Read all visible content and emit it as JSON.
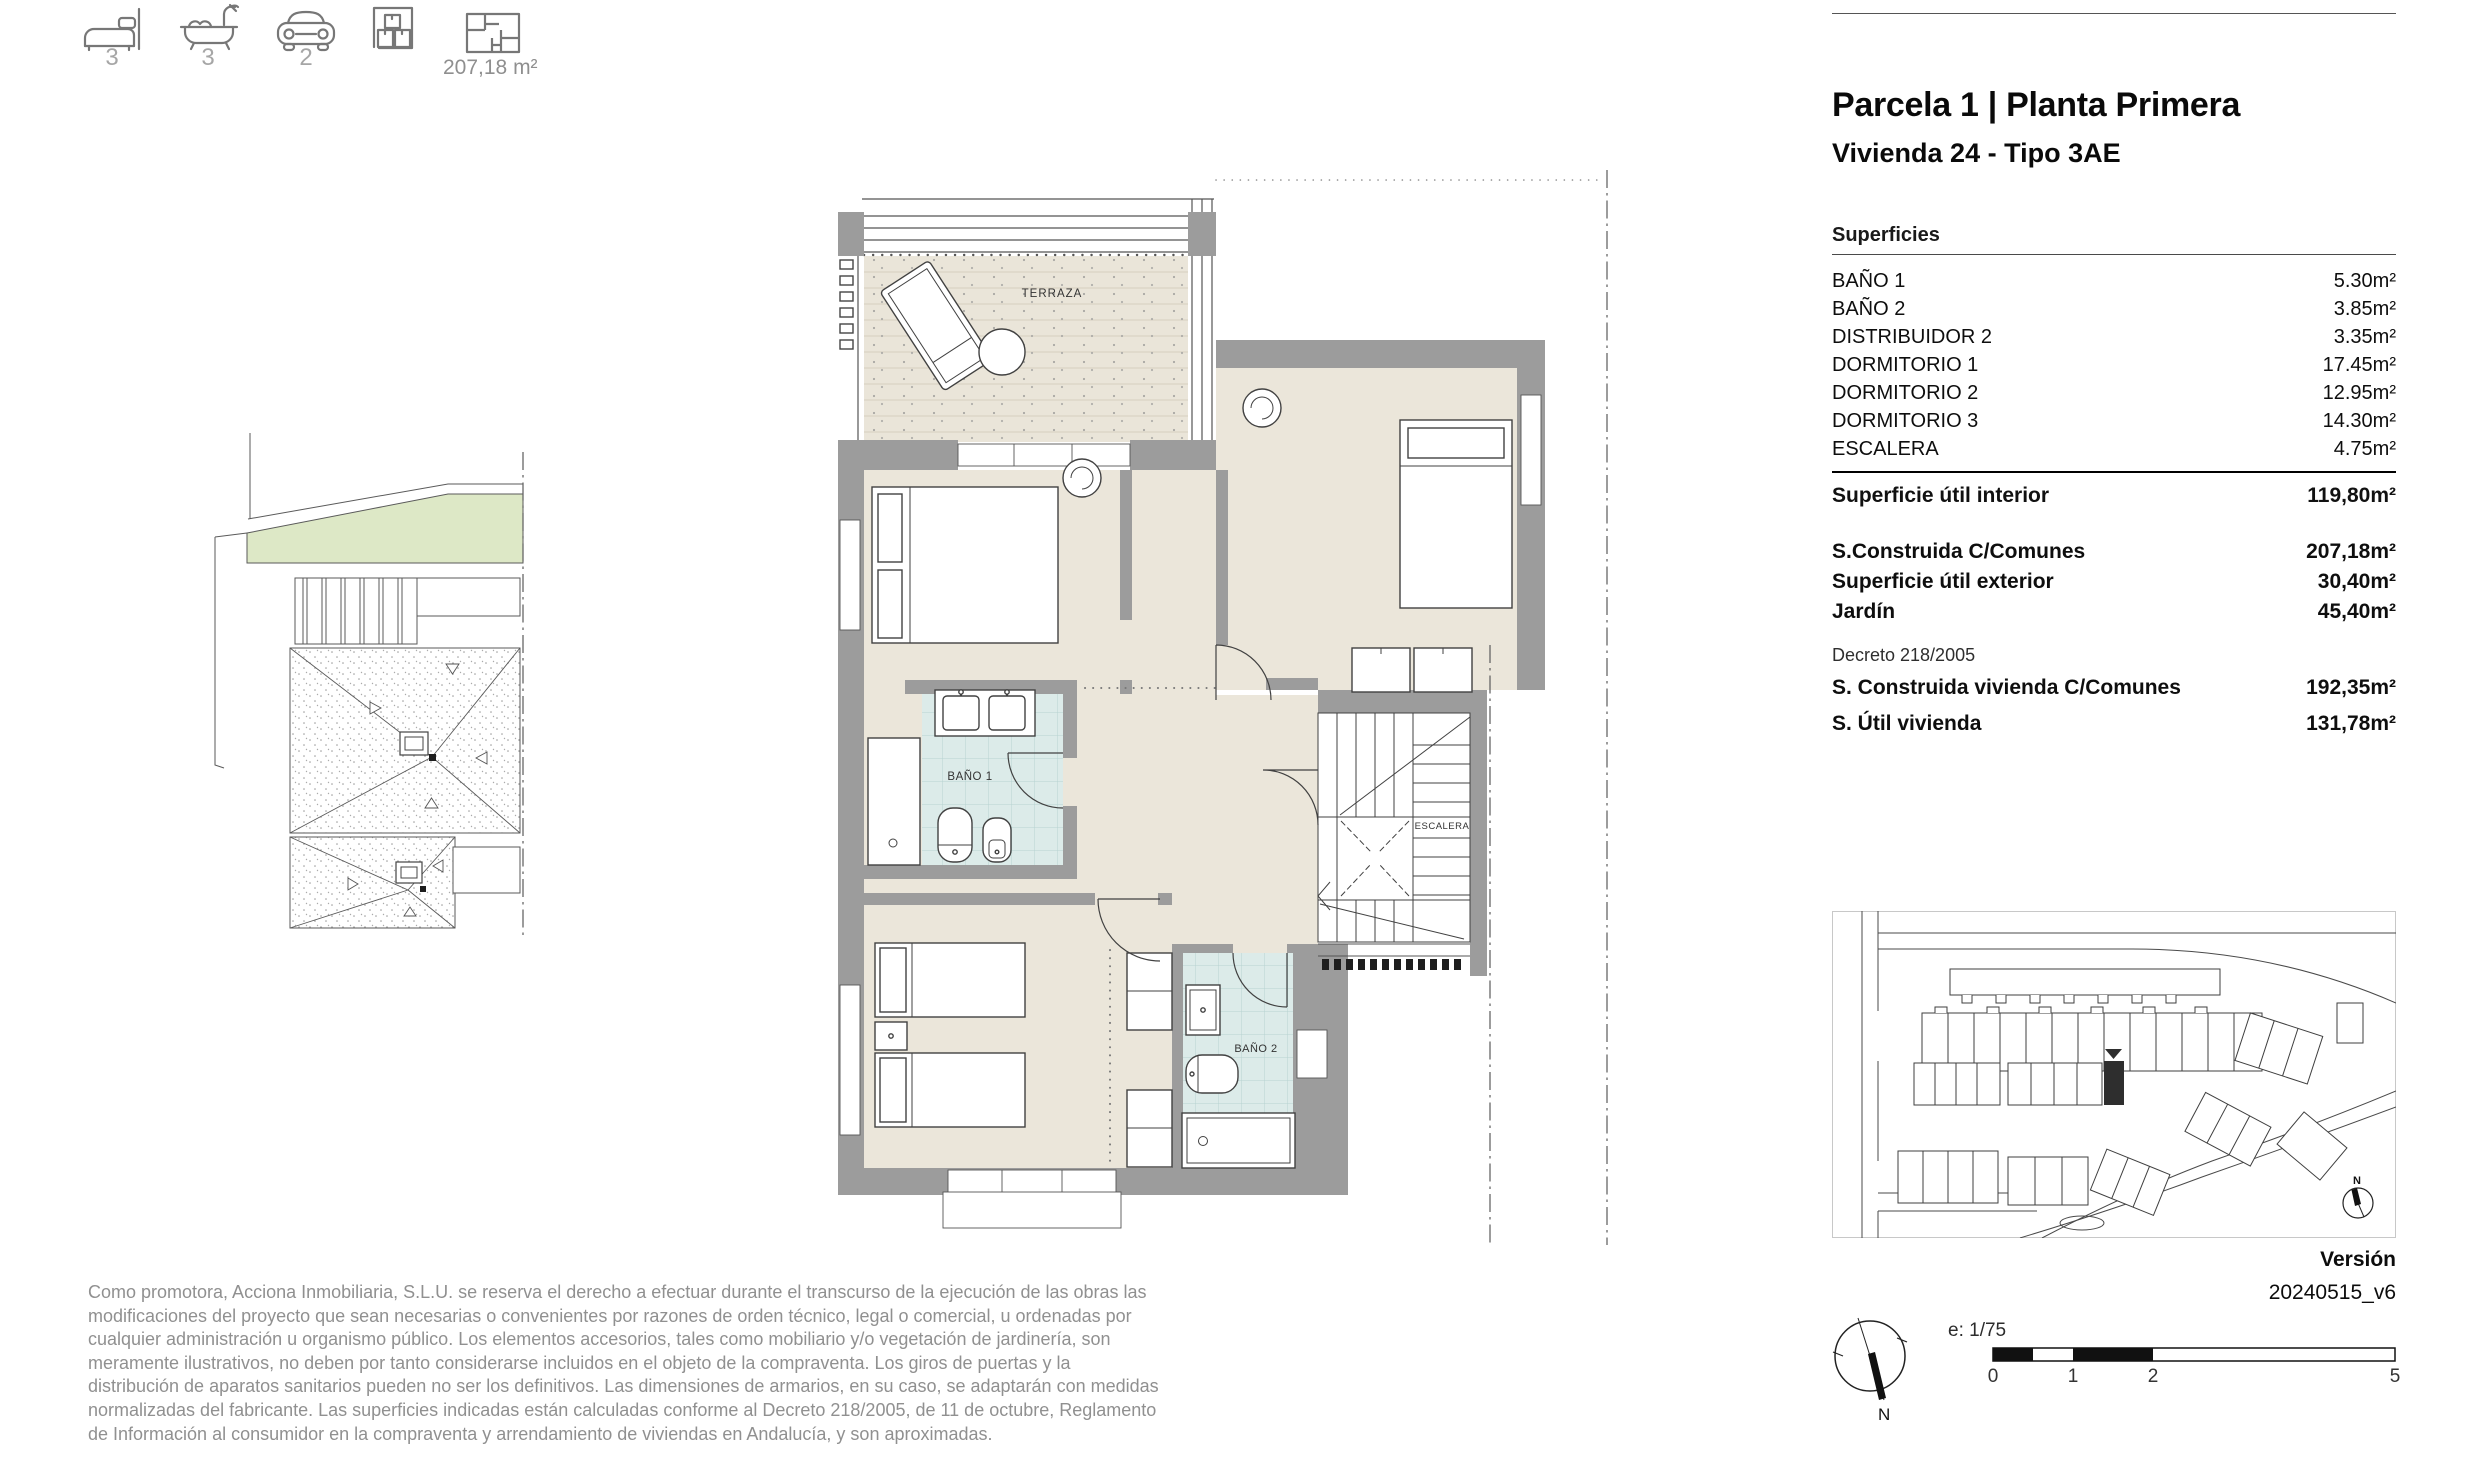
{
  "header_icons": {
    "bedrooms_count": "3",
    "bathrooms_count": "3",
    "parking_count": "2",
    "built_area_label": "207,18 m²"
  },
  "panel": {
    "title": "Parcela 1 | Planta Primera",
    "subtitle": "Vivienda 24 - Tipo 3AE",
    "surfaces_heading": "Superficies",
    "surfaces": [
      {
        "label": "BAÑO 1",
        "value": "5.30m²"
      },
      {
        "label": "BAÑO 2",
        "value": "3.85m²"
      },
      {
        "label": "DISTRIBUIDOR 2",
        "value": "3.35m²"
      },
      {
        "label": "DORMITORIO 1",
        "value": "17.45m²"
      },
      {
        "label": "DORMITORIO 2",
        "value": "12.95m²"
      },
      {
        "label": "DORMITORIO 3",
        "value": "14.30m²"
      },
      {
        "label": "ESCALERA",
        "value": "4.75m²"
      }
    ],
    "interior": {
      "label": "Superficie útil interior",
      "value": "119,80m²"
    },
    "totals": [
      {
        "label": "S.Construida C/Comunes",
        "value": "207,18m²"
      },
      {
        "label": "Superficie útil exterior",
        "value": "30,40m²"
      },
      {
        "label": "Jardín",
        "value": "45,40m²"
      }
    ],
    "decreto_label": "Decreto 218/2005",
    "decreto_rows": [
      {
        "label": "S. Construida vivienda C/Comunes",
        "value": "192,35m²"
      },
      {
        "label": "S. Útil vivienda",
        "value": "131,78m²"
      }
    ]
  },
  "plan_labels": {
    "terraza": "TERRAZA",
    "bano1": "BAÑO 1",
    "escalera": "ESCALERA",
    "bano2": "BAÑO 2"
  },
  "site_map": {
    "compass_n": "N"
  },
  "footer": {
    "version_label": "Versión",
    "version_value": "20240515_v6",
    "scale_label": "e:  1/75",
    "scale_ticks": [
      "0",
      "1",
      "2",
      "5"
    ],
    "compass_n": "N",
    "disclaimer": "Como promotora, Acciona Inmobiliaria, S.L.U. se reserva el derecho a efectuar durante el transcurso de la ejecución de las obras las modificaciones del proyecto que sean necesarias o convenientes por razones de orden técnico, legal o comercial, u ordenadas por cualquier administración u organismo público. Los elementos accesorios, tales como mobiliario y/o vegetación de jardinería, son meramente ilustrativos, no deben por tanto considerarse incluidos en el objeto de la compraventa. Los giros de puertas y la distribución de aparatos sanitarios pueden no ser los definitivos. Las dimensiones de armarios, en su caso, se adaptarán con medidas normalizadas del fabricante. Las superficies indicadas están calculadas conforme al Decreto 218/2005, de 11 de octubre, Reglamento de Información al consumidor en la compraventa y arrendamiento de viviendas en Andalucía, y son aproximadas."
  },
  "colors": {
    "wall_gray": "#9c9c9c",
    "floor_beige": "#ebe6da",
    "terrace_beige": "#eae5d9",
    "tile_blue": "#dcebe9",
    "garden_green": "#dde8c6",
    "highlight_black": "#2e2e2e",
    "muted_text": "#909090"
  }
}
